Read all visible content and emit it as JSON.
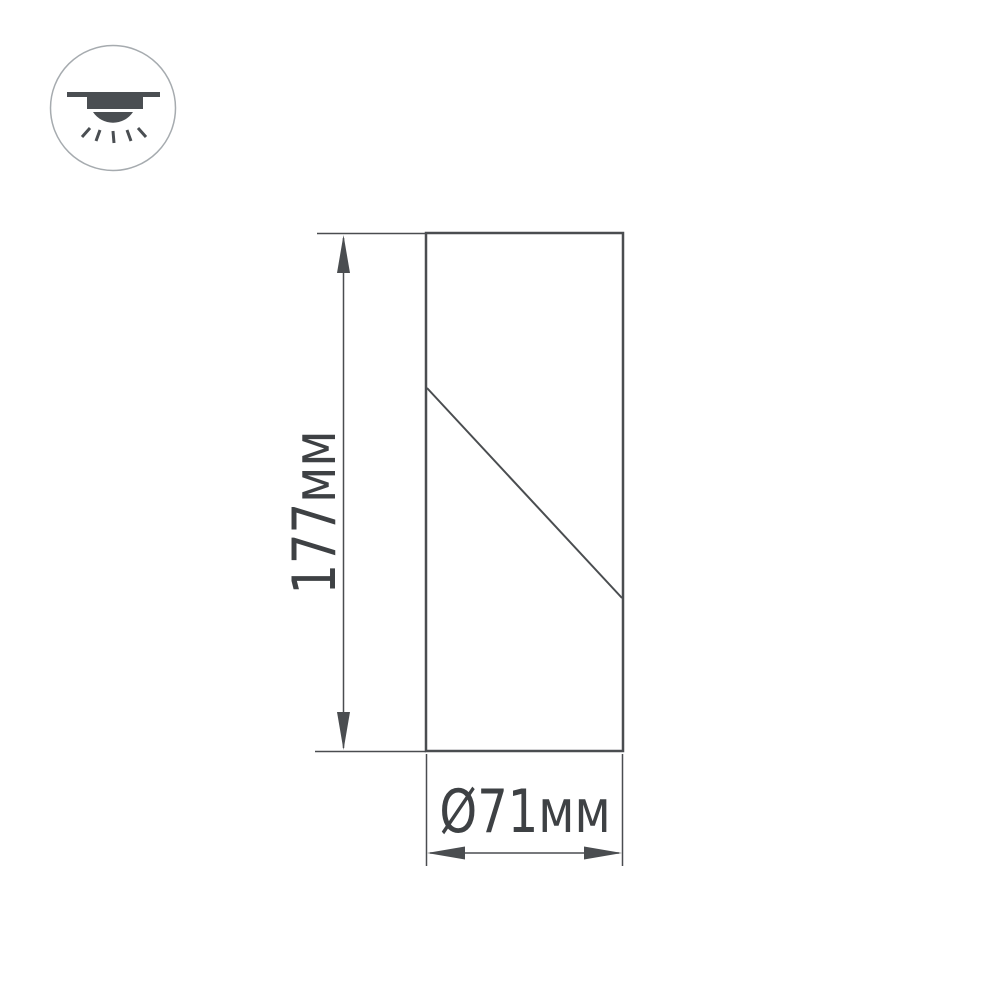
{
  "badge": {
    "icon": "surface-mounted-downlight-icon"
  },
  "drawing": {
    "height_label": "177мм",
    "height_value_mm": 177,
    "diameter_label": "Ø71мм",
    "diameter_value_mm": 71
  },
  "colors": {
    "background": "#ffffff",
    "drawing_line": "#4a4d50",
    "dimension_text": "#3e4144",
    "icon_glyph": "#4a4e52",
    "badge_outline": "#a6abaf"
  }
}
